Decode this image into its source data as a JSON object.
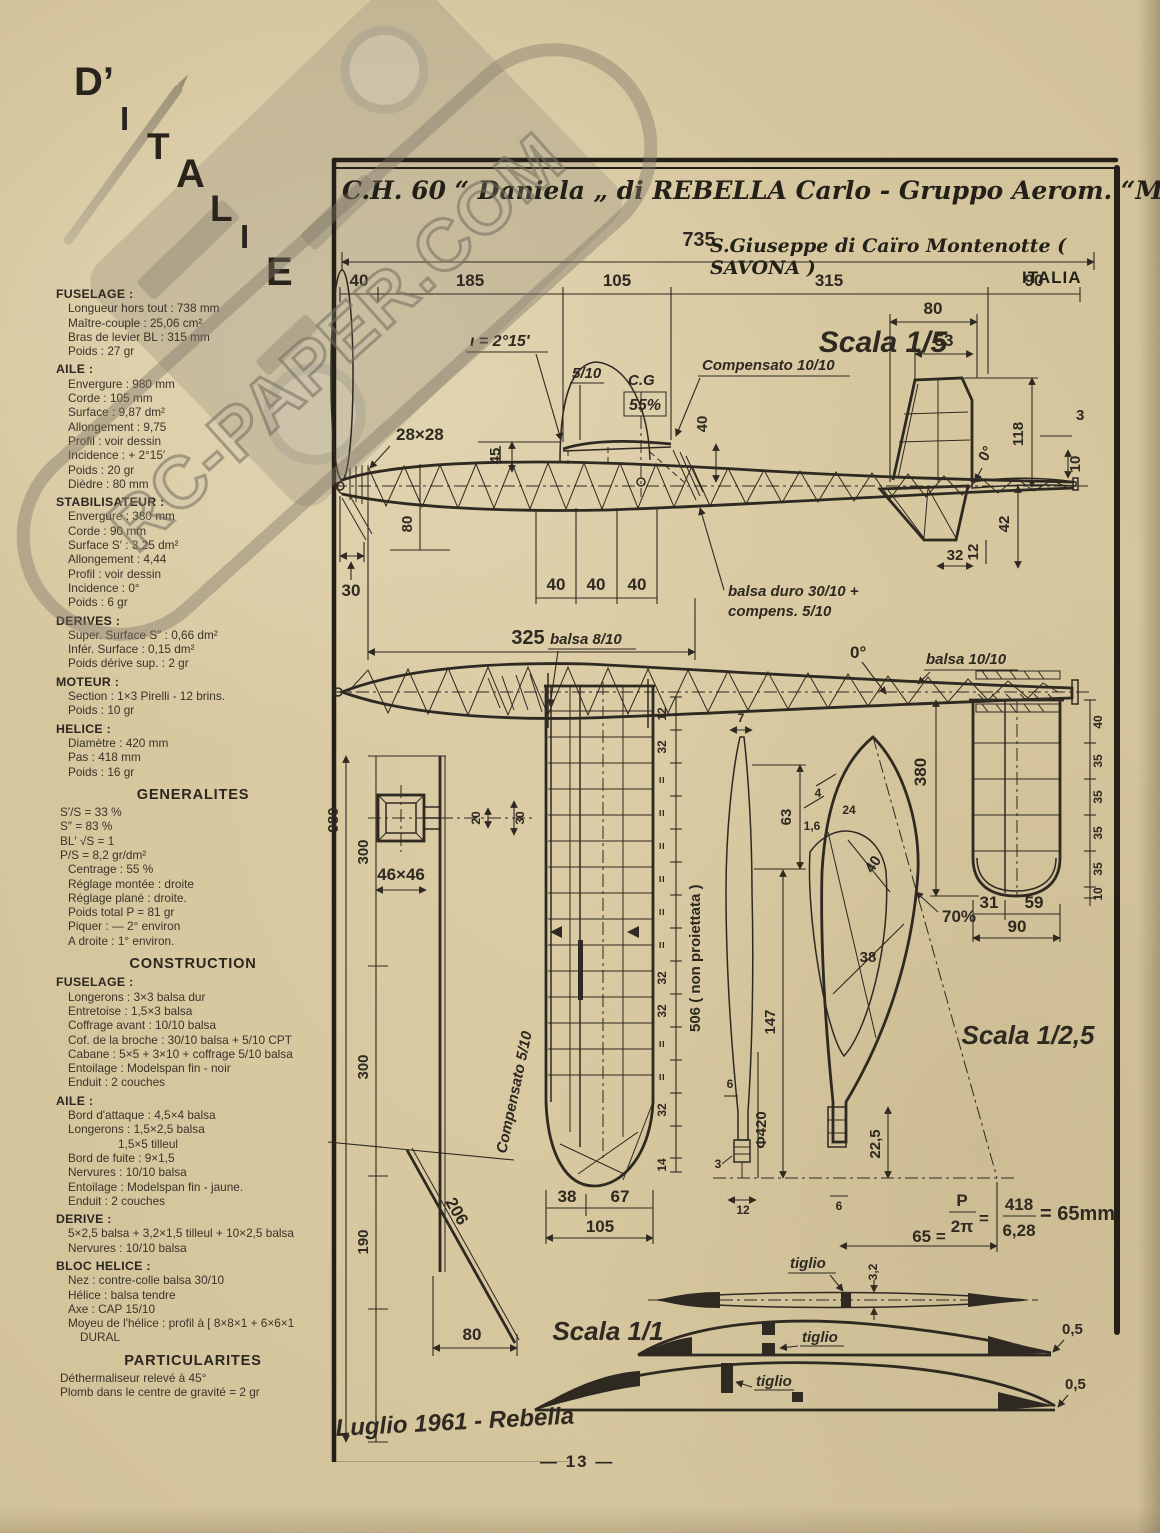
{
  "page": {
    "number": "— 13 —"
  },
  "masthead": {
    "letters": [
      "D’",
      "I",
      "T",
      "A",
      "L",
      "I",
      "E"
    ]
  },
  "watermark": {
    "text": "RC-PAPER.COM"
  },
  "title": {
    "line1": "C.H. 60 “ Daniela „ di REBELLA Carlo - Gruppo Aerom. “MONTECATINI„",
    "line2": "S.Giuseppe di Caïro Montenotte ( SAVONA )",
    "line3": "ITALIA"
  },
  "sidebar": {
    "items": [
      {
        "style": "h",
        "text": "FUSELAGE :"
      },
      {
        "style": "l",
        "text": "Longueur hors tout : 738 mm"
      },
      {
        "style": "l",
        "text": "Maître-couple : 25,06 cm²"
      },
      {
        "style": "l",
        "text": "Bras de levier BL : 315 mm"
      },
      {
        "style": "l",
        "text": "Poids : 27 gr"
      },
      {
        "style": "h",
        "text": "AILE :"
      },
      {
        "style": "l",
        "text": "Envergure : 980 mm"
      },
      {
        "style": "l",
        "text": "Corde : 105 mm"
      },
      {
        "style": "l",
        "text": "Surface : 9,87 dm²"
      },
      {
        "style": "l",
        "text": "Allongement : 9,75"
      },
      {
        "style": "l",
        "text": "Profil : voir dessin"
      },
      {
        "style": "l",
        "text": "Incidence : + 2°15′"
      },
      {
        "style": "l",
        "text": "Poids : 20 gr"
      },
      {
        "style": "l",
        "text": "Dièdre : 80 mm"
      },
      {
        "style": "h",
        "text": "STABILISATEUR :"
      },
      {
        "style": "l",
        "text": "Envergure : 380 mm"
      },
      {
        "style": "l",
        "text": "Corde : 90 mm"
      },
      {
        "style": "l",
        "text": "Surface S′ : 3,25 dm²"
      },
      {
        "style": "l",
        "text": "Allongement : 4,44"
      },
      {
        "style": "l",
        "text": "Profil : voir dessin"
      },
      {
        "style": "l",
        "text": "Incidence : 0°"
      },
      {
        "style": "l",
        "text": "Poids : 6 gr"
      },
      {
        "style": "h",
        "text": "DERIVES :"
      },
      {
        "style": "l",
        "text": "Super. Surface S″ : 0,66 dm²"
      },
      {
        "style": "l",
        "text": "Infér. Surface : 0,15 dm²"
      },
      {
        "style": "l",
        "text": "Poids dérive sup. : 2 gr"
      },
      {
        "style": "h",
        "text": "MOTEUR :"
      },
      {
        "style": "l",
        "text": "Section : 1×3 Pirelli - 12 brins."
      },
      {
        "style": "l",
        "text": "Poids : 10 gr"
      },
      {
        "style": "h",
        "text": "HELICE :"
      },
      {
        "style": "l",
        "text": "Diamètre : 420 mm"
      },
      {
        "style": "l",
        "text": "Pas : 418 mm"
      },
      {
        "style": "l",
        "text": "Poids : 16 gr"
      },
      {
        "style": "c",
        "text": "GENERALITES"
      },
      {
        "style": "f",
        "text": "S′/S = 33 %"
      },
      {
        "style": "f",
        "text": "S″ = 83 %"
      },
      {
        "style": "f",
        "text": "BL′ √S = 1"
      },
      {
        "style": "f",
        "text": "P/S = 8,2 gr/dm²"
      },
      {
        "style": "l",
        "text": "Centrage : 55 %"
      },
      {
        "style": "l",
        "text": "Réglage montée : droite"
      },
      {
        "style": "l",
        "text": "Réglage plané : droite."
      },
      {
        "style": "l",
        "text": "Poids total P = 81 gr"
      },
      {
        "style": "l",
        "text": "Piquer : — 2° environ"
      },
      {
        "style": "l",
        "text": "A droite : 1° environ."
      },
      {
        "style": "c",
        "text": "CONSTRUCTION"
      },
      {
        "style": "h",
        "text": "FUSELAGE :"
      },
      {
        "style": "l",
        "text": "Longerons : 3×3 balsa dur"
      },
      {
        "style": "l",
        "text": "Entretoise : 1,5×3 balsa"
      },
      {
        "style": "l",
        "text": "Coffrage avant : 10/10 balsa"
      },
      {
        "style": "l",
        "text": "Cof. de la broche : 30/10 balsa + 5/10 CPT"
      },
      {
        "style": "l",
        "text": "Cabane : 5×5 + 3×10 + coffrage 5/10 balsa"
      },
      {
        "style": "l",
        "text": "Entoilage : Modelspan fin - noir"
      },
      {
        "style": "l",
        "text": "Enduit : 2 couches"
      },
      {
        "style": "h",
        "text": "AILE :"
      },
      {
        "style": "l",
        "text": "Bord d'attaque : 4,5×4 balsa"
      },
      {
        "style": "l",
        "text": "Longerons : 1,5×2,5 balsa"
      },
      {
        "style": "l2",
        "text": "1,5×5 tilleul"
      },
      {
        "style": "l",
        "text": "Bord de fuite : 9×1,5"
      },
      {
        "style": "l",
        "text": "Nervures : 10/10 balsa"
      },
      {
        "style": "l",
        "text": "Entoilage : Modelspan fin - jaune."
      },
      {
        "style": "l",
        "text": "Enduit : 2 couches"
      },
      {
        "style": "h",
        "text": "DERIVE :"
      },
      {
        "style": "l",
        "text": "5×2,5 balsa + 3,2×1,5 tilleul + 10×2,5 balsa"
      },
      {
        "style": "l",
        "text": "Nervures : 10/10 balsa"
      },
      {
        "style": "h",
        "text": "BLOC HELICE :"
      },
      {
        "style": "l",
        "text": "Nez : contre-colle balsa 30/10"
      },
      {
        "style": "l",
        "text": "Hélice : balsa tendre"
      },
      {
        "style": "l",
        "text": "Axe : CAP 15/10"
      },
      {
        "style": "l",
        "text": "Moyeu de l'hélice : profil à [ 8×8×1 + 6×6×1 DURAL"
      },
      {
        "style": "c",
        "text": "PARTICULARITES"
      },
      {
        "style": "f",
        "text": "Déthermaliseur relevé à 45°"
      },
      {
        "style": "f",
        "text": "Plomb dans le centre de gravité = 2 gr"
      }
    ]
  },
  "drawing": {
    "scala15": "Scala 1/5",
    "scala125": "Scala 1/2,5",
    "scala11": "Scala 1/1",
    "dim735": "735",
    "seg": [
      "40",
      "185",
      "105",
      "315",
      "90"
    ],
    "side": {
      "incidence": "ι = 2°15′",
      "s510": "5/10",
      "cg": "C.G",
      "cg55": "55%",
      "compensato1010": "Compensato 10/10",
      "d40": "40",
      "d28x28": "28×28",
      "d45": "45",
      "d80": "80",
      "d40a": "40",
      "d40b": "40",
      "d40c": "40",
      "d325": "325",
      "d30": "30",
      "balsaduro1": "balsa duro 30/10 +",
      "balsaduro2": "compens. 5/10",
      "fin80": "80",
      "fin53": "53",
      "fin118": "118",
      "deg0": "0°",
      "fin3": "3",
      "fin10": "10",
      "fin42": "42",
      "fin12": "12",
      "fin32": "32"
    },
    "plan": {
      "balsa810": "balsa 8/10",
      "deg0": "0°",
      "balsa1010": "balsa 10/10"
    },
    "front": {
      "d300a": "300",
      "d980": "980",
      "d300b": "300",
      "d190": "190",
      "d46": "46×46",
      "d30": "30",
      "d20": "20",
      "d206": "206",
      "d80": "80"
    },
    "wing": {
      "compensato510": "Compensato 5/10",
      "d12": "12",
      "d32": "32",
      "deq": "=",
      "d506": "506 ( non proiettata )",
      "d14": "14",
      "d38": "38",
      "d67": "67",
      "d105": "105"
    },
    "prop": {
      "d7": "7",
      "d63": "63",
      "d4": "4",
      "d24": "24",
      "d16": "1,6",
      "d40": "40",
      "d38": "38",
      "d147": "147",
      "phi420": "Φ420",
      "d6a": "6",
      "d3": "3",
      "d12": "12",
      "d225": "22,5",
      "d6b": "6",
      "pct70": "70%"
    },
    "formula": {
      "left": "65 =",
      "p": "P",
      "twopi": "2π",
      "eq": "=",
      "num": "418",
      "den": "6,28",
      "result": "= 65mm"
    },
    "stab": {
      "d380": "380",
      "chain": [
        "40",
        "35",
        "35",
        "35",
        "35",
        "10"
      ],
      "d31": "31",
      "d59": "59",
      "d90": "90"
    },
    "sections": {
      "tiglio": "tiglio",
      "t32": "3,2",
      "t05": "0,5"
    },
    "signature": "Luglio 1961 - Rebella"
  }
}
